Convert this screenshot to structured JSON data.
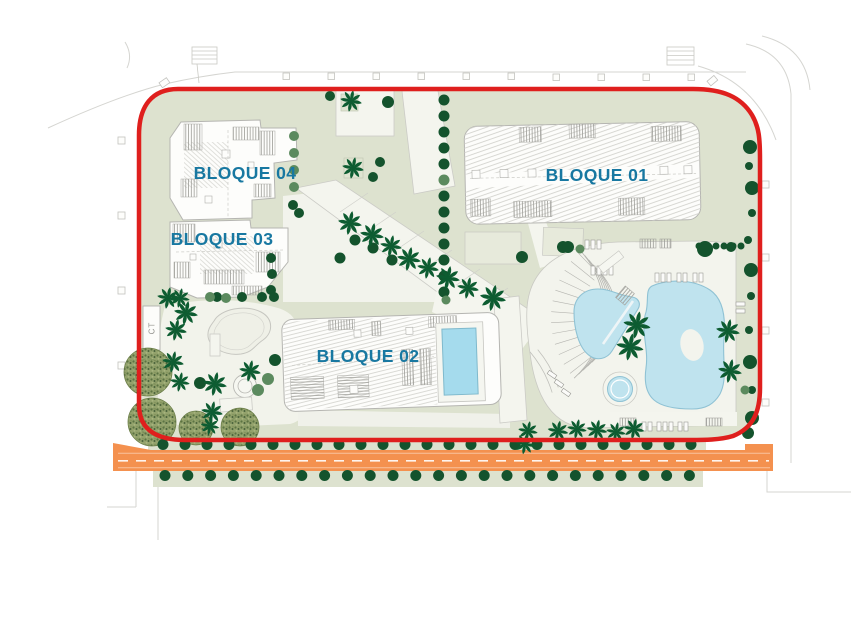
{
  "plan": {
    "labels": {
      "block01": "BLOQUE 01",
      "block02": "BLOQUE 02",
      "block03": "BLOQUE 03",
      "block04": "BLOQUE 04",
      "ct": "CT"
    },
    "colors": {
      "label_teal": "#1878a1",
      "boundary_red": "#df1f1d",
      "road_orange": "#f4914f",
      "pool_cyan": "#bfe3ee",
      "pool_deep": "#a5dbed",
      "pool_edge": "#8fc2d4",
      "site_green": "#dde2cf",
      "site_light": "#e9ebdd",
      "tree_dark": "#14532d",
      "palm_green": "#0d5c31",
      "tree_olive": "#5b8a5e"
    }
  }
}
